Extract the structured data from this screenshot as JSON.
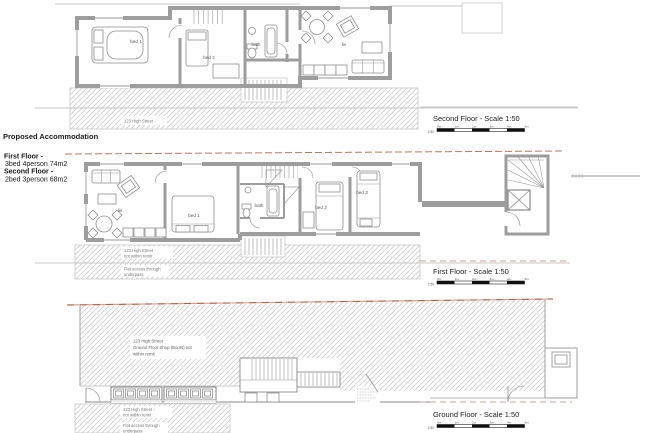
{
  "accommodation": {
    "heading": "Proposed Accommodation",
    "lines": [
      {
        "label": "First Floor -",
        "spec": "3bed 4person 74m2"
      },
      {
        "label": "Second Floor -",
        "spec": "2bed 3person 68m2"
      }
    ]
  },
  "titles": {
    "second_floor": "Second Floor - Scale 1:50",
    "first_floor": "First Floor - Scale 1:50",
    "ground_floor": "Ground Floor - Scale 1:50"
  },
  "second_floor_plan": {
    "bed1": "bed 1",
    "bed2": "bed 2",
    "bath": "bath",
    "liv": "liv",
    "street_note": "123 High Street -"
  },
  "first_floor_plan": {
    "liv": "liv",
    "bed1": "bed 1",
    "bath": "bath",
    "bed2": "bed 2",
    "bed3": "bed 3",
    "street_note": "123 High Street -",
    "remit_note": "not within remit",
    "access_note_1": "Flat access through",
    "access_note_2": "underpass"
  },
  "ground_floor_plan": {
    "shop_note_1": "123 High Street",
    "shop_note_2": "Ground Floor Shop (Boots) not",
    "shop_note_3": "within remit",
    "street_note": "123 High Street -",
    "remit_note": "not within remit",
    "access_note_1": "Flat access through",
    "access_note_2": "underpass"
  },
  "scale_bar": {
    "ratio": "1:50",
    "ticks": [
      "0m",
      "1m",
      "2m",
      "3m",
      "4m",
      "5m"
    ]
  },
  "colors": {
    "wall": "#9d9d9d",
    "hatch": "#cccccc",
    "boundary": "#c4765a",
    "text": "#1a1a1a"
  }
}
